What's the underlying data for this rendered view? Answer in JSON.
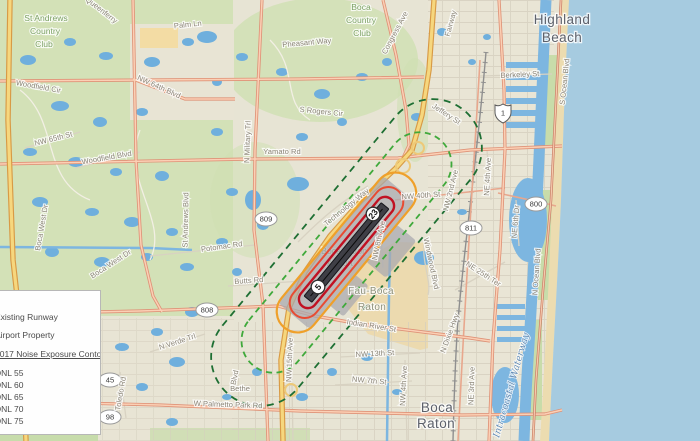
{
  "legend": {
    "title_fragment": "9",
    "items": [
      "Existing Runway",
      "Airport Property"
    ],
    "contours_heading": "2017 Noise Exposure Contours",
    "dnl_items": [
      "DNL 55",
      "DNL 60",
      "DNL 65",
      "DNL 70",
      "DNL 75"
    ],
    "note_line1": "Day-Night Average",
    "note_line2": "Level"
  },
  "contour_colors": {
    "dnl55": "#1e6f33",
    "dnl60": "#3fa93b",
    "dnl65": "#efa02a",
    "dnl70": "#e74c33",
    "dnl75": "#c11122"
  },
  "map_colors": {
    "ocean": "#a6cbe0",
    "pond": "#6fafdd",
    "land": "#e7e4d4",
    "green": "#cfe0b2",
    "highway": "#f6d77e",
    "major_road": "#f3bd9e",
    "runway": "#3f3f46",
    "airport_property": "#a9a9af"
  },
  "map": {
    "runway_markers": [
      {
        "t": "23",
        "x": 373,
        "y": 214,
        "r": -51
      },
      {
        "t": "5",
        "x": 318,
        "y": 287,
        "r": -51
      }
    ],
    "shields": [
      {
        "t": "809",
        "x": 266,
        "y": 219,
        "k": "oval"
      },
      {
        "t": "808",
        "x": 207,
        "y": 310,
        "k": "oval"
      },
      {
        "t": "811",
        "x": 471,
        "y": 228,
        "k": "oval"
      },
      {
        "t": "800",
        "x": 536,
        "y": 204,
        "k": "oval"
      },
      {
        "t": "45",
        "x": 110,
        "y": 380,
        "k": "oval"
      },
      {
        "t": "98",
        "x": 110,
        "y": 417,
        "k": "oval"
      },
      {
        "t": "1",
        "x": 503,
        "y": 113,
        "k": "us"
      }
    ],
    "labels": [
      {
        "t": "St Andrews",
        "x": 46,
        "y": 21,
        "r": 0,
        "c": "club"
      },
      {
        "t": "Country",
        "x": 45,
        "y": 34,
        "r": 0,
        "c": "club"
      },
      {
        "t": "Club",
        "x": 44,
        "y": 47,
        "r": 0,
        "c": "club"
      },
      {
        "t": "Boca",
        "x": 361,
        "y": 10,
        "r": 0,
        "c": "club"
      },
      {
        "t": "Country",
        "x": 361,
        "y": 23,
        "r": 0,
        "c": "club"
      },
      {
        "t": "Club",
        "x": 362,
        "y": 36,
        "r": 0,
        "c": "club"
      },
      {
        "t": "Highland",
        "x": 562,
        "y": 24,
        "r": 0,
        "c": "city"
      },
      {
        "t": "Beach",
        "x": 562,
        "y": 42,
        "r": 0,
        "c": "city"
      },
      {
        "t": "Boca",
        "x": 437,
        "y": 412,
        "r": 0,
        "c": "city"
      },
      {
        "t": "Raton",
        "x": 436,
        "y": 428,
        "r": 0,
        "c": "city"
      },
      {
        "t": "Fau-Boca",
        "x": 371,
        "y": 294,
        "r": 0,
        "c": "campus"
      },
      {
        "t": "Raton",
        "x": 372,
        "y": 310,
        "r": 0,
        "c": "campus"
      },
      {
        "t": "Boca Raton",
        "x": 344,
        "y": 254,
        "r": 0,
        "c": "airport"
      },
      {
        "t": "Airport",
        "x": 340,
        "y": 266,
        "r": 0,
        "c": "airport"
      },
      {
        "t": "Queenferry",
        "x": 100,
        "y": 12,
        "r": 38,
        "c": "road"
      },
      {
        "t": "Palm Ln",
        "x": 188,
        "y": 27,
        "r": -6,
        "c": "road"
      },
      {
        "t": "NW 64th Blvd",
        "x": 158,
        "y": 89,
        "r": 24,
        "c": "road"
      },
      {
        "t": "Woodfield Cir",
        "x": 38,
        "y": 89,
        "r": 10,
        "c": "road"
      },
      {
        "t": "NW 65th St",
        "x": 54,
        "y": 141,
        "r": -14,
        "c": "road"
      },
      {
        "t": "Pheasant Way",
        "x": 307,
        "y": 45,
        "r": -5,
        "c": "road"
      },
      {
        "t": "Congress Ave",
        "x": 397,
        "y": 34,
        "r": -62,
        "c": "road"
      },
      {
        "t": "Fairway",
        "x": 453,
        "y": 24,
        "r": -75,
        "c": "road"
      },
      {
        "t": "Jeffery St",
        "x": 445,
        "y": 116,
        "r": 33,
        "c": "road"
      },
      {
        "t": "Berkeley St",
        "x": 520,
        "y": 77,
        "r": -3,
        "c": "road"
      },
      {
        "t": "S Ocean Blvd",
        "x": 567,
        "y": 82,
        "r": -84,
        "c": "road"
      },
      {
        "t": "N Military Trl",
        "x": 250,
        "y": 142,
        "r": -88,
        "c": "road"
      },
      {
        "t": "Yamato Rd",
        "x": 282,
        "y": 154,
        "r": 0,
        "c": "road"
      },
      {
        "t": "S Rogers Cir",
        "x": 321,
        "y": 114,
        "r": 6,
        "c": "road"
      },
      {
        "t": "Woodfield Blvd",
        "x": 107,
        "y": 160,
        "r": -10,
        "c": "road"
      },
      {
        "t": "Boca West Dr",
        "x": 44,
        "y": 228,
        "r": -80,
        "c": "road"
      },
      {
        "t": "Boca West Dr",
        "x": 112,
        "y": 266,
        "r": -33,
        "c": "road"
      },
      {
        "t": "St Andrews Blvd",
        "x": 188,
        "y": 220,
        "r": -89,
        "c": "road"
      },
      {
        "t": "Potomac Rd",
        "x": 222,
        "y": 249,
        "r": -8,
        "c": "road"
      },
      {
        "t": "Butts Rd",
        "x": 249,
        "y": 283,
        "r": -4,
        "c": "road"
      },
      {
        "t": "Technology Way",
        "x": 348,
        "y": 209,
        "r": -39,
        "c": "road"
      },
      {
        "t": "NW 40th St",
        "x": 421,
        "y": 198,
        "r": -4,
        "c": "road"
      },
      {
        "t": "NW 2nd Ave",
        "x": 453,
        "y": 191,
        "r": -76,
        "c": "road"
      },
      {
        "t": "NE 4th Ave",
        "x": 490,
        "y": 177,
        "r": -87,
        "c": "road"
      },
      {
        "t": "NE 6th Dr",
        "x": 518,
        "y": 222,
        "r": -85,
        "c": "road"
      },
      {
        "t": "NW 8th Ave",
        "x": 381,
        "y": 241,
        "r": -78,
        "c": "road"
      },
      {
        "t": "Windwood Blvd",
        "x": 429,
        "y": 264,
        "r": 78,
        "c": "road"
      },
      {
        "t": "NE 25th Ter",
        "x": 482,
        "y": 276,
        "r": 33,
        "c": "road"
      },
      {
        "t": "N Ocean Blvd",
        "x": 539,
        "y": 272,
        "r": -86,
        "c": "road"
      },
      {
        "t": "Indian River St",
        "x": 371,
        "y": 328,
        "r": 9,
        "c": "road"
      },
      {
        "t": "NW 13th St",
        "x": 375,
        "y": 356,
        "r": -3,
        "c": "road"
      },
      {
        "t": "NW 7th St",
        "x": 369,
        "y": 383,
        "r": 5,
        "c": "road"
      },
      {
        "t": "NW 15th Ave",
        "x": 292,
        "y": 360,
        "r": -88,
        "c": "road"
      },
      {
        "t": "NW 4th Ave",
        "x": 406,
        "y": 386,
        "r": -87,
        "c": "road"
      },
      {
        "t": "N Dixie Hwy",
        "x": 452,
        "y": 334,
        "r": -70,
        "c": "road"
      },
      {
        "t": "NE 3rd Ave",
        "x": 474,
        "y": 386,
        "r": -88,
        "c": "road"
      },
      {
        "t": "W Palmetto Park Rd",
        "x": 228,
        "y": 407,
        "r": 2,
        "c": "road"
      },
      {
        "t": "Toledo Rd",
        "x": 123,
        "y": 394,
        "r": -80,
        "c": "road"
      },
      {
        "t": "N Verde Trl",
        "x": 178,
        "y": 344,
        "r": -18,
        "c": "road"
      },
      {
        "t": "Blvd",
        "x": 237,
        "y": 378,
        "r": -78,
        "c": "road"
      },
      {
        "t": "Bethe",
        "x": 240,
        "y": 391,
        "r": 0,
        "c": "road"
      },
      {
        "t": "Intracoastal Waterway",
        "x": 514,
        "y": 386,
        "r": -74,
        "c": "water"
      }
    ],
    "ponds": [
      [
        28,
        60,
        8,
        5
      ],
      [
        70,
        42,
        6,
        4
      ],
      [
        106,
        56,
        7,
        4
      ],
      [
        152,
        62,
        8,
        5
      ],
      [
        188,
        42,
        6,
        4
      ],
      [
        60,
        106,
        9,
        5
      ],
      [
        100,
        122,
        7,
        5
      ],
      [
        142,
        112,
        6,
        4
      ],
      [
        30,
        152,
        7,
        4
      ],
      [
        76,
        162,
        8,
        5
      ],
      [
        116,
        172,
        6,
        4
      ],
      [
        162,
        176,
        7,
        5
      ],
      [
        40,
        202,
        8,
        5
      ],
      [
        92,
        212,
        7,
        4
      ],
      [
        132,
        222,
        8,
        5
      ],
      [
        172,
        232,
        6,
        4
      ],
      [
        52,
        252,
        7,
        5
      ],
      [
        102,
        262,
        8,
        5
      ],
      [
        147,
        257,
        6,
        4
      ],
      [
        187,
        267,
        7,
        4
      ],
      [
        25,
        302,
        8,
        5
      ],
      [
        67,
        312,
        6,
        4
      ],
      [
        192,
        312,
        7,
        5
      ],
      [
        157,
        332,
        6,
        4
      ],
      [
        122,
        347,
        7,
        4
      ],
      [
        177,
        362,
        8,
        5
      ],
      [
        142,
        387,
        6,
        4
      ],
      [
        82,
        422,
        7,
        4
      ],
      [
        172,
        422,
        6,
        4
      ],
      [
        217,
        132,
        6,
        4
      ],
      [
        217,
        82,
        5,
        4
      ],
      [
        242,
        57,
        6,
        4
      ],
      [
        282,
        72,
        6,
        4
      ],
      [
        322,
        94,
        8,
        5
      ],
      [
        362,
        77,
        6,
        4
      ],
      [
        298,
        184,
        11,
        7
      ],
      [
        232,
        192,
        6,
        4
      ],
      [
        222,
        242,
        6,
        4
      ],
      [
        237,
        272,
        5,
        4
      ],
      [
        424,
        258,
        10,
        7
      ],
      [
        302,
        137,
        6,
        4
      ],
      [
        342,
        122,
        5,
        4
      ],
      [
        387,
        62,
        5,
        4
      ],
      [
        442,
        32,
        5,
        4
      ],
      [
        417,
        117,
        6,
        4
      ],
      [
        462,
        212,
        5,
        3
      ],
      [
        367,
        357,
        6,
        4
      ],
      [
        332,
        372,
        5,
        4
      ],
      [
        397,
        392,
        5,
        3
      ],
      [
        302,
        397,
        6,
        4
      ],
      [
        257,
        372,
        5,
        4
      ],
      [
        227,
        397,
        5,
        3
      ],
      [
        472,
        62,
        4,
        3
      ],
      [
        487,
        37,
        4,
        3
      ],
      [
        207,
        37,
        10,
        6
      ],
      [
        253,
        200,
        8,
        10
      ],
      [
        263,
        225,
        6,
        5
      ]
    ]
  }
}
